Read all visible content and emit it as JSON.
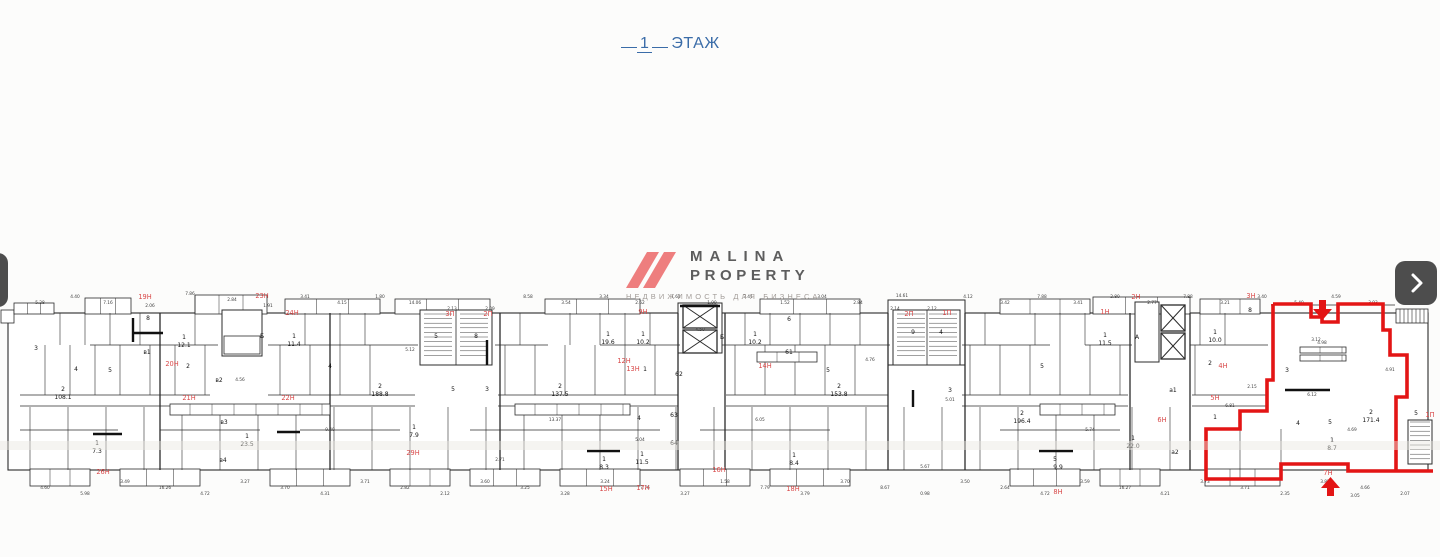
{
  "title": {
    "number": "1",
    "label": "ЭТАЖ",
    "color": "#3a6ca8"
  },
  "logo": {
    "line1": "MALINA",
    "line2": "PROPERTY",
    "subtitle": "НЕДВИЖИМОСТЬ ДЛЯ БИЗНЕСА",
    "mark_color": "#ee7e7e",
    "text_color": "#5d5d5d",
    "subtitle_color": "#a39d99"
  },
  "icons": {
    "prev": "chevron-left",
    "next": "chevron-right"
  },
  "floorplan": {
    "wall_color": "#2b2b2b",
    "highlight_color": "#e31515",
    "red_label_color": "#d84848",
    "red_labels": [
      {
        "t": "19Н",
        "x": 145,
        "y": 299
      },
      {
        "t": "23Н",
        "x": 262,
        "y": 298
      },
      {
        "t": "24Н",
        "x": 292,
        "y": 315
      },
      {
        "t": "20Н",
        "x": 172,
        "y": 366
      },
      {
        "t": "21Н",
        "x": 189,
        "y": 400
      },
      {
        "t": "22Н",
        "x": 288,
        "y": 400
      },
      {
        "t": "26Н",
        "x": 103,
        "y": 474
      },
      {
        "t": "29Н",
        "x": 413,
        "y": 455
      },
      {
        "t": "3П",
        "x": 450,
        "y": 316
      },
      {
        "t": "2П",
        "x": 488,
        "y": 316
      },
      {
        "t": "9Н",
        "x": 643,
        "y": 314
      },
      {
        "t": "12Н",
        "x": 624,
        "y": 363
      },
      {
        "t": "13Н",
        "x": 633,
        "y": 371
      },
      {
        "t": "14Н",
        "x": 765,
        "y": 368
      },
      {
        "t": "15Н",
        "x": 606,
        "y": 491
      },
      {
        "t": "17Н",
        "x": 643,
        "y": 490
      },
      {
        "t": "16Н",
        "x": 719,
        "y": 472
      },
      {
        "t": "18Н",
        "x": 793,
        "y": 491
      },
      {
        "t": "2П",
        "x": 909,
        "y": 316
      },
      {
        "t": "1П",
        "x": 947,
        "y": 315
      },
      {
        "t": "1Н",
        "x": 1105,
        "y": 314
      },
      {
        "t": "2Н",
        "x": 1136,
        "y": 299
      },
      {
        "t": "6Н",
        "x": 1162,
        "y": 422
      },
      {
        "t": "8Н",
        "x": 1058,
        "y": 494
      },
      {
        "t": "3Н",
        "x": 1251,
        "y": 298
      },
      {
        "t": "4Н",
        "x": 1223,
        "y": 368
      },
      {
        "t": "5Н",
        "x": 1215,
        "y": 400
      },
      {
        "t": "7Н",
        "x": 1328,
        "y": 475
      },
      {
        "t": "1П",
        "x": 1430,
        "y": 417
      }
    ],
    "room_labels": [
      {
        "t": "3",
        "x": 36,
        "y": 350
      },
      {
        "t": "2",
        "x": 63,
        "y": 391,
        "s": 4.5
      },
      {
        "t": "108.1",
        "x": 63,
        "y": 399
      },
      {
        "t": "1",
        "x": 97,
        "y": 445,
        "s": 4.5
      },
      {
        "t": "7.3",
        "x": 97,
        "y": 453
      },
      {
        "t": "8",
        "x": 148,
        "y": 320
      },
      {
        "t": "в1",
        "x": 147,
        "y": 354
      },
      {
        "t": "4",
        "x": 76,
        "y": 371
      },
      {
        "t": "5",
        "x": 110,
        "y": 372
      },
      {
        "t": "1",
        "x": 184,
        "y": 339,
        "s": 4.5
      },
      {
        "t": "12.1",
        "x": 184,
        "y": 347
      },
      {
        "t": "2",
        "x": 188,
        "y": 368
      },
      {
        "t": "в2",
        "x": 219,
        "y": 382
      },
      {
        "t": "Б",
        "x": 262,
        "y": 338
      },
      {
        "t": "1",
        "x": 294,
        "y": 338,
        "s": 4.5
      },
      {
        "t": "11.4",
        "x": 294,
        "y": 346
      },
      {
        "t": "4",
        "x": 330,
        "y": 368
      },
      {
        "t": "2",
        "x": 380,
        "y": 388,
        "s": 4.5
      },
      {
        "t": "188.8",
        "x": 380,
        "y": 396
      },
      {
        "t": "в3",
        "x": 224,
        "y": 424
      },
      {
        "t": "1",
        "x": 247,
        "y": 438,
        "s": 4.5
      },
      {
        "t": "23.5",
        "x": 247,
        "y": 446
      },
      {
        "t": "в4",
        "x": 223,
        "y": 462
      },
      {
        "t": "1",
        "x": 414,
        "y": 429,
        "s": 4.5
      },
      {
        "t": "7.9",
        "x": 414,
        "y": 437
      },
      {
        "t": "5",
        "x": 436,
        "y": 338
      },
      {
        "t": "8",
        "x": 476,
        "y": 338
      },
      {
        "t": "5",
        "x": 453,
        "y": 391
      },
      {
        "t": "3",
        "x": 487,
        "y": 391
      },
      {
        "t": "2",
        "x": 560,
        "y": 388,
        "s": 4.5
      },
      {
        "t": "137.5",
        "x": 560,
        "y": 396
      },
      {
        "t": "1",
        "x": 608,
        "y": 336,
        "s": 4.5
      },
      {
        "t": "19.6",
        "x": 608,
        "y": 344
      },
      {
        "t": "1",
        "x": 643,
        "y": 336,
        "s": 4.5
      },
      {
        "t": "10.2",
        "x": 643,
        "y": 344
      },
      {
        "t": "1",
        "x": 645,
        "y": 371
      },
      {
        "t": "62",
        "x": 679,
        "y": 376
      },
      {
        "t": "4",
        "x": 639,
        "y": 420
      },
      {
        "t": "63",
        "x": 674,
        "y": 417
      },
      {
        "t": "64",
        "x": 674,
        "y": 445
      },
      {
        "t": "1",
        "x": 604,
        "y": 461,
        "s": 4.5
      },
      {
        "t": "8.3",
        "x": 604,
        "y": 469
      },
      {
        "t": "1",
        "x": 642,
        "y": 456,
        "s": 4.5
      },
      {
        "t": "11.5",
        "x": 642,
        "y": 464
      },
      {
        "t": "Б",
        "x": 722,
        "y": 339
      },
      {
        "t": "6",
        "x": 789,
        "y": 321
      },
      {
        "t": "1",
        "x": 755,
        "y": 336,
        "s": 4.5
      },
      {
        "t": "10.2",
        "x": 755,
        "y": 344
      },
      {
        "t": "61",
        "x": 789,
        "y": 354
      },
      {
        "t": "5",
        "x": 828,
        "y": 372
      },
      {
        "t": "2",
        "x": 839,
        "y": 388,
        "s": 4.5
      },
      {
        "t": "153.8",
        "x": 839,
        "y": 396
      },
      {
        "t": "1",
        "x": 794,
        "y": 457,
        "s": 4.5
      },
      {
        "t": "8.4",
        "x": 794,
        "y": 465
      },
      {
        "t": "9",
        "x": 913,
        "y": 334
      },
      {
        "t": "4",
        "x": 941,
        "y": 334
      },
      {
        "t": "3",
        "x": 950,
        "y": 392
      },
      {
        "t": "2",
        "x": 1022,
        "y": 415,
        "s": 4.5
      },
      {
        "t": "196.4",
        "x": 1022,
        "y": 423
      },
      {
        "t": "1",
        "x": 1105,
        "y": 337,
        "s": 4.5
      },
      {
        "t": "11.5",
        "x": 1105,
        "y": 345
      },
      {
        "t": "А",
        "x": 1137,
        "y": 339
      },
      {
        "t": "5",
        "x": 1042,
        "y": 368
      },
      {
        "t": "1",
        "x": 1133,
        "y": 440,
        "s": 4.5
      },
      {
        "t": "22.0",
        "x": 1133,
        "y": 448
      },
      {
        "t": "5",
        "x": 1055,
        "y": 461,
        "s": 4.5
      },
      {
        "t": "9.9",
        "x": 1058,
        "y": 469
      },
      {
        "t": "а1",
        "x": 1173,
        "y": 392
      },
      {
        "t": "а2",
        "x": 1175,
        "y": 454
      },
      {
        "t": "8",
        "x": 1250,
        "y": 312
      },
      {
        "t": "1",
        "x": 1215,
        "y": 334,
        "s": 4.5
      },
      {
        "t": "10.0",
        "x": 1215,
        "y": 342
      },
      {
        "t": "2",
        "x": 1210,
        "y": 365
      },
      {
        "t": "1",
        "x": 1215,
        "y": 419
      },
      {
        "t": "3",
        "x": 1287,
        "y": 372
      },
      {
        "t": "4",
        "x": 1298,
        "y": 425
      },
      {
        "t": "5",
        "x": 1330,
        "y": 424
      },
      {
        "t": "2",
        "x": 1371,
        "y": 414,
        "s": 4.5
      },
      {
        "t": "171.4",
        "x": 1371,
        "y": 422
      },
      {
        "t": "1",
        "x": 1332,
        "y": 442,
        "s": 4.5
      },
      {
        "t": "8.7",
        "x": 1332,
        "y": 450
      },
      {
        "t": "5",
        "x": 1416,
        "y": 415
      }
    ],
    "dim_labels": [
      {
        "t": "5.28",
        "x": 40,
        "y": 304
      },
      {
        "t": "4.40",
        "x": 75,
        "y": 298
      },
      {
        "t": "7.16",
        "x": 108,
        "y": 304
      },
      {
        "t": "2.06",
        "x": 150,
        "y": 307
      },
      {
        "t": "7.86",
        "x": 190,
        "y": 295
      },
      {
        "t": "2.84",
        "x": 232,
        "y": 301
      },
      {
        "t": "1.91",
        "x": 268,
        "y": 307
      },
      {
        "t": "3.41",
        "x": 305,
        "y": 298
      },
      {
        "t": "4.15",
        "x": 342,
        "y": 304
      },
      {
        "t": "1.80",
        "x": 380,
        "y": 298
      },
      {
        "t": "14.06",
        "x": 415,
        "y": 304
      },
      {
        "t": "2.13",
        "x": 452,
        "y": 310
      },
      {
        "t": "2.09",
        "x": 490,
        "y": 310
      },
      {
        "t": "8.58",
        "x": 528,
        "y": 298
      },
      {
        "t": "3.54",
        "x": 566,
        "y": 304
      },
      {
        "t": "3.34",
        "x": 604,
        "y": 298
      },
      {
        "t": "2.62",
        "x": 640,
        "y": 304
      },
      {
        "t": "1.61",
        "x": 676,
        "y": 298
      },
      {
        "t": "1.99",
        "x": 712,
        "y": 304
      },
      {
        "t": "3.41",
        "x": 748,
        "y": 298
      },
      {
        "t": "1.52",
        "x": 785,
        "y": 304
      },
      {
        "t": "3.04",
        "x": 822,
        "y": 298
      },
      {
        "t": "2.84",
        "x": 858,
        "y": 304
      },
      {
        "t": "2.14",
        "x": 895,
        "y": 310
      },
      {
        "t": "2.12",
        "x": 932,
        "y": 310
      },
      {
        "t": "14.61",
        "x": 902,
        "y": 297
      },
      {
        "t": "4.12",
        "x": 968,
        "y": 298
      },
      {
        "t": "3.42",
        "x": 1005,
        "y": 304
      },
      {
        "t": "7.88",
        "x": 1042,
        "y": 298
      },
      {
        "t": "3.41",
        "x": 1078,
        "y": 304
      },
      {
        "t": "2.80",
        "x": 1115,
        "y": 298
      },
      {
        "t": "2.77",
        "x": 1152,
        "y": 304
      },
      {
        "t": "7.88",
        "x": 1188,
        "y": 298
      },
      {
        "t": "3.21",
        "x": 1225,
        "y": 304
      },
      {
        "t": "3.40",
        "x": 1262,
        "y": 298
      },
      {
        "t": "5.40",
        "x": 1299,
        "y": 304
      },
      {
        "t": "4.59",
        "x": 1336,
        "y": 298
      },
      {
        "t": "3.93",
        "x": 1373,
        "y": 304
      },
      {
        "t": "4.17",
        "x": 1410,
        "y": 298
      },
      {
        "t": "4.60",
        "x": 45,
        "y": 489
      },
      {
        "t": "5.98",
        "x": 85,
        "y": 495
      },
      {
        "t": "3.49",
        "x": 125,
        "y": 483
      },
      {
        "t": "16.26",
        "x": 165,
        "y": 489
      },
      {
        "t": "4.72",
        "x": 205,
        "y": 495
      },
      {
        "t": "3.27",
        "x": 245,
        "y": 483
      },
      {
        "t": "3.70",
        "x": 285,
        "y": 489
      },
      {
        "t": "4.31",
        "x": 325,
        "y": 495
      },
      {
        "t": "3.71",
        "x": 365,
        "y": 483
      },
      {
        "t": "2.82",
        "x": 405,
        "y": 489
      },
      {
        "t": "2.12",
        "x": 445,
        "y": 495
      },
      {
        "t": "3.60",
        "x": 485,
        "y": 483
      },
      {
        "t": "3.25",
        "x": 525,
        "y": 489
      },
      {
        "t": "3.28",
        "x": 565,
        "y": 495
      },
      {
        "t": "3.24",
        "x": 605,
        "y": 483
      },
      {
        "t": "7.76",
        "x": 645,
        "y": 489
      },
      {
        "t": "3.27",
        "x": 685,
        "y": 495
      },
      {
        "t": "1.58",
        "x": 725,
        "y": 483
      },
      {
        "t": "7.79",
        "x": 765,
        "y": 489
      },
      {
        "t": "3.79",
        "x": 805,
        "y": 495
      },
      {
        "t": "3.70",
        "x": 845,
        "y": 483
      },
      {
        "t": "8.67",
        "x": 885,
        "y": 489
      },
      {
        "t": "0.98",
        "x": 925,
        "y": 495
      },
      {
        "t": "3.50",
        "x": 965,
        "y": 483
      },
      {
        "t": "2.64",
        "x": 1005,
        "y": 489
      },
      {
        "t": "4.72",
        "x": 1045,
        "y": 495
      },
      {
        "t": "3.59",
        "x": 1085,
        "y": 483
      },
      {
        "t": "16.27",
        "x": 1125,
        "y": 489
      },
      {
        "t": "4.21",
        "x": 1165,
        "y": 495
      },
      {
        "t": "3.73",
        "x": 1205,
        "y": 483
      },
      {
        "t": "3.71",
        "x": 1245,
        "y": 489
      },
      {
        "t": "2.35",
        "x": 1285,
        "y": 495
      },
      {
        "t": "3.85",
        "x": 1325,
        "y": 483
      },
      {
        "t": "4.66",
        "x": 1365,
        "y": 489
      },
      {
        "t": "2.07",
        "x": 1405,
        "y": 495
      },
      {
        "t": "4.56",
        "x": 240,
        "y": 381
      },
      {
        "t": "5.12",
        "x": 410,
        "y": 351
      },
      {
        "t": "13.37",
        "x": 555,
        "y": 421
      },
      {
        "t": "6.05",
        "x": 760,
        "y": 421
      },
      {
        "t": "5.01",
        "x": 950,
        "y": 401
      },
      {
        "t": "5.74",
        "x": 1090,
        "y": 431
      },
      {
        "t": "9.40",
        "x": 330,
        "y": 431
      },
      {
        "t": "5.04",
        "x": 640,
        "y": 441
      },
      {
        "t": "4.76",
        "x": 870,
        "y": 361
      },
      {
        "t": "6.81",
        "x": 1230,
        "y": 407
      },
      {
        "t": "3.05",
        "x": 1355,
        "y": 497
      },
      {
        "t": "3.12",
        "x": 1316,
        "y": 341
      },
      {
        "t": "4.91",
        "x": 1390,
        "y": 371
      },
      {
        "t": "2.71",
        "x": 500,
        "y": 461
      },
      {
        "t": "4.50",
        "x": 700,
        "y": 331
      },
      {
        "t": "5.67",
        "x": 925,
        "y": 468
      },
      {
        "t": "4.98",
        "x": 1322,
        "y": 344
      },
      {
        "t": "4.69",
        "x": 1352,
        "y": 431
      },
      {
        "t": "6.12",
        "x": 1312,
        "y": 396
      },
      {
        "t": "2.15",
        "x": 1252,
        "y": 388
      }
    ]
  }
}
